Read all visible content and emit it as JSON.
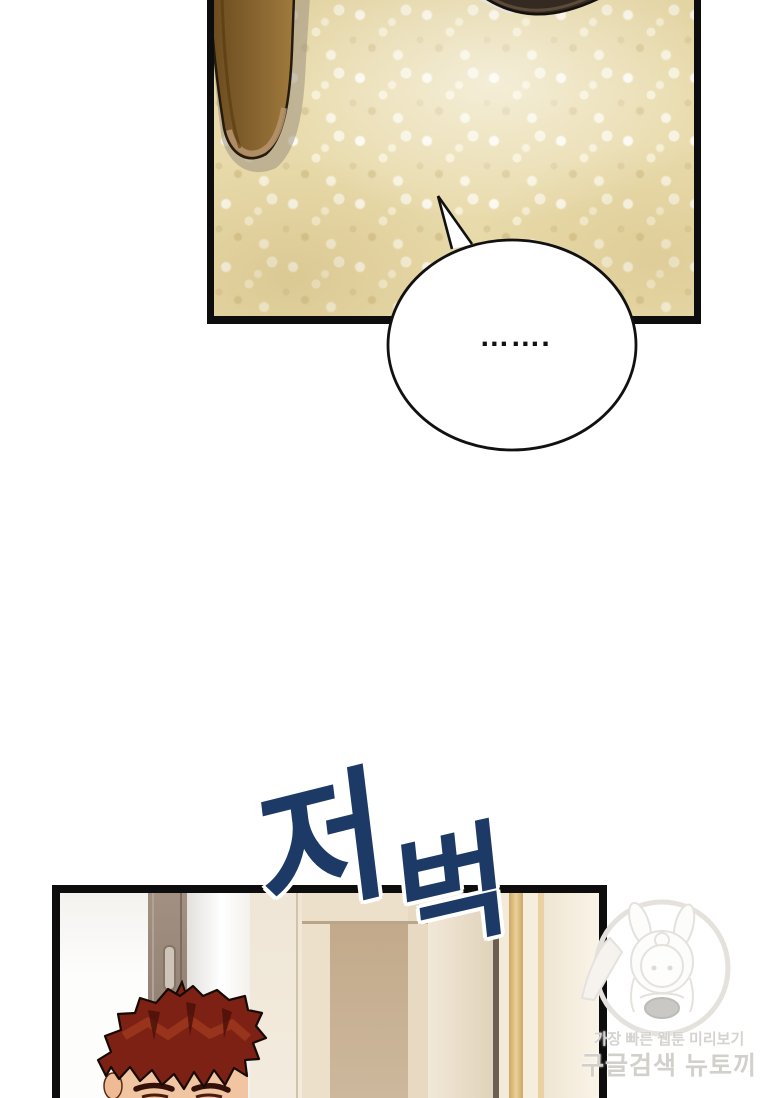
{
  "comic": {
    "speech_bubble": {
      "text": "……."
    },
    "sfx": {
      "char1": "저",
      "char2": "벅",
      "full_text": "저벅",
      "color": "#1d3a66",
      "outline_color": "#ffffff"
    },
    "watermark": {
      "line1": "가장 빠른 웹툰 미리보기",
      "line2": "구글검색 뉴토끼",
      "text_color": "#d5d3cf",
      "logo": "bunny-girl-mascot"
    },
    "colors": {
      "page_background": "#ffffff",
      "panel_border": "#0d0d0d",
      "carpet": "#e8daaa",
      "furniture_leg_brown": "#7a5722",
      "dark_object": "#342a21",
      "hallway_cream": "#f3ebdd",
      "hallway_door_beige": "#c2a98a",
      "gold_trim": "#ecd096",
      "left_door_gray_brown": "#9a8a7c",
      "character_hair": "#7c2113",
      "character_skin": "#f2c5a2"
    }
  }
}
